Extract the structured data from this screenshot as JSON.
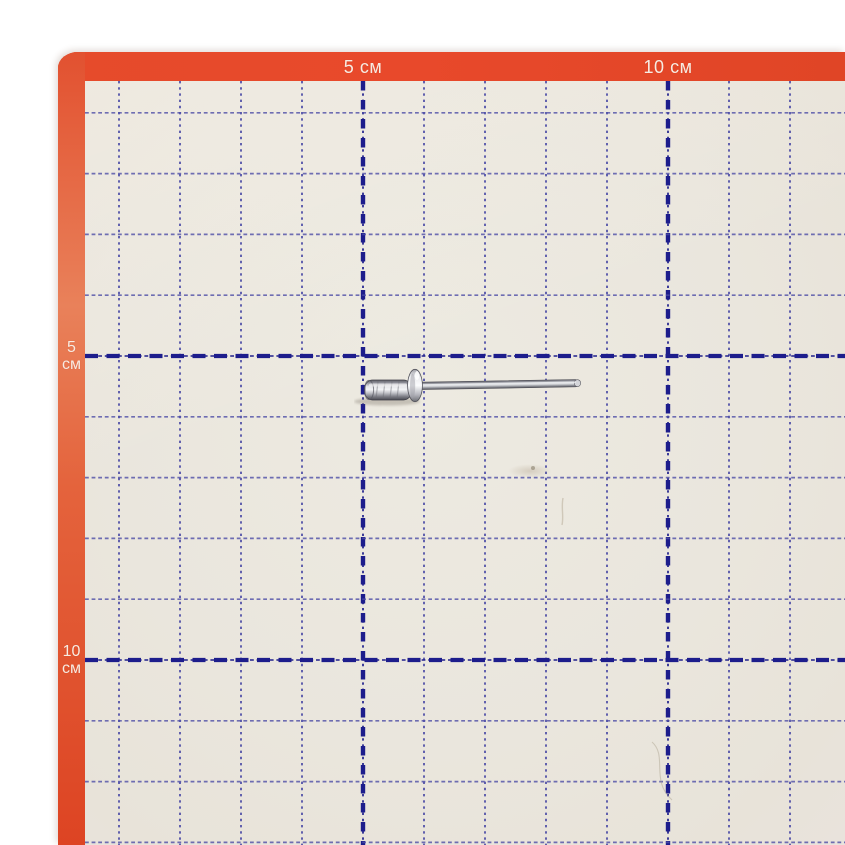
{
  "scene": {
    "type": "photograph",
    "subject": "aluminium blind pop rivet lying on an orange-bordered centimetre measuring grid mat",
    "page_bg": "#ffffff"
  },
  "mat": {
    "border_color": "#e24a29",
    "surface_color": "#eae6dd",
    "origin": {
      "x": 58,
      "y": 52
    },
    "border_top_px": 29,
    "border_left_px": 27
  },
  "grid": {
    "cm_px_x": 61,
    "cm_px_y": 60.8,
    "columns": 12,
    "rows": 13,
    "major_every_cm": 5,
    "minor_color": "#4d4da6",
    "major_color": "#1d1d8c"
  },
  "rulers": {
    "text_color": "#f7ebe2",
    "unit": "см",
    "top": [
      {
        "label": "5 см",
        "cm": 5
      },
      {
        "label": "10 см",
        "cm": 10
      }
    ],
    "left": [
      {
        "value": "5",
        "unit": "см",
        "cm": 5
      },
      {
        "value": "10",
        "unit": "см",
        "cm": 10
      }
    ]
  },
  "object": {
    "type": "blind-pop-rivet",
    "metal_color": "#c9cbd0",
    "approx_length_cm": 3.6,
    "starts_at_cm_x": 5,
    "lies_at_cm_y": 5.4
  }
}
